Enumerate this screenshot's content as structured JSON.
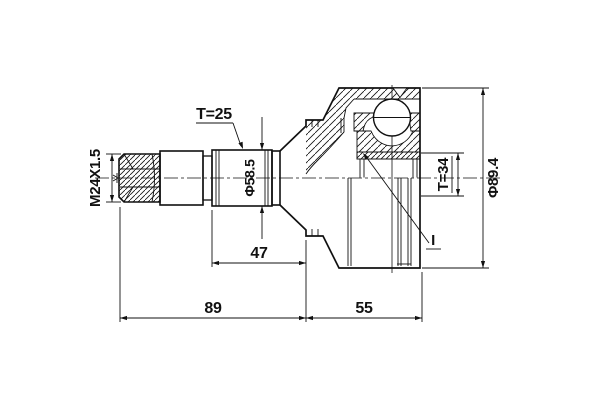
{
  "drawing": {
    "labels": {
      "thread_spec": "M24X1.5",
      "outer_spline_teeth": "T=25",
      "outer_spline_diameter": "Φ58.5",
      "spline_section_length": "47",
      "shaft_length": "89",
      "body_length": "55",
      "inner_spline_teeth": "T=34",
      "body_diameter": "Φ89.4",
      "detail_mark": "I"
    },
    "colors": {
      "line": "#111111",
      "background": "#ffffff"
    }
  }
}
